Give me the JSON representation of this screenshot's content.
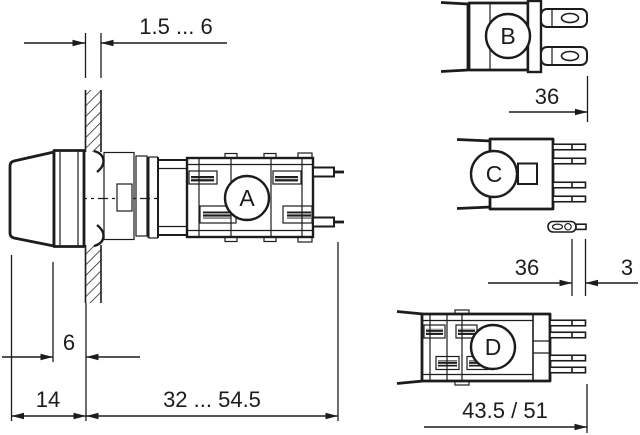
{
  "views": {
    "a": {
      "label": "A"
    },
    "b": {
      "label": "B"
    },
    "c": {
      "label": "C"
    },
    "d": {
      "label": "D"
    }
  },
  "dimensions": {
    "panel_thickness": "1.5 ... 6",
    "lens_to_panel": "6",
    "front_depth": "14",
    "mounting_depth": "32 ... 54.5",
    "b_terminal_depth": "36",
    "c_pin_depth": "36",
    "c_pin_tip": "3",
    "d_depth": "43.5 / 51"
  },
  "colors": {
    "line": "#1c1c1c",
    "background": "#ffffff"
  }
}
